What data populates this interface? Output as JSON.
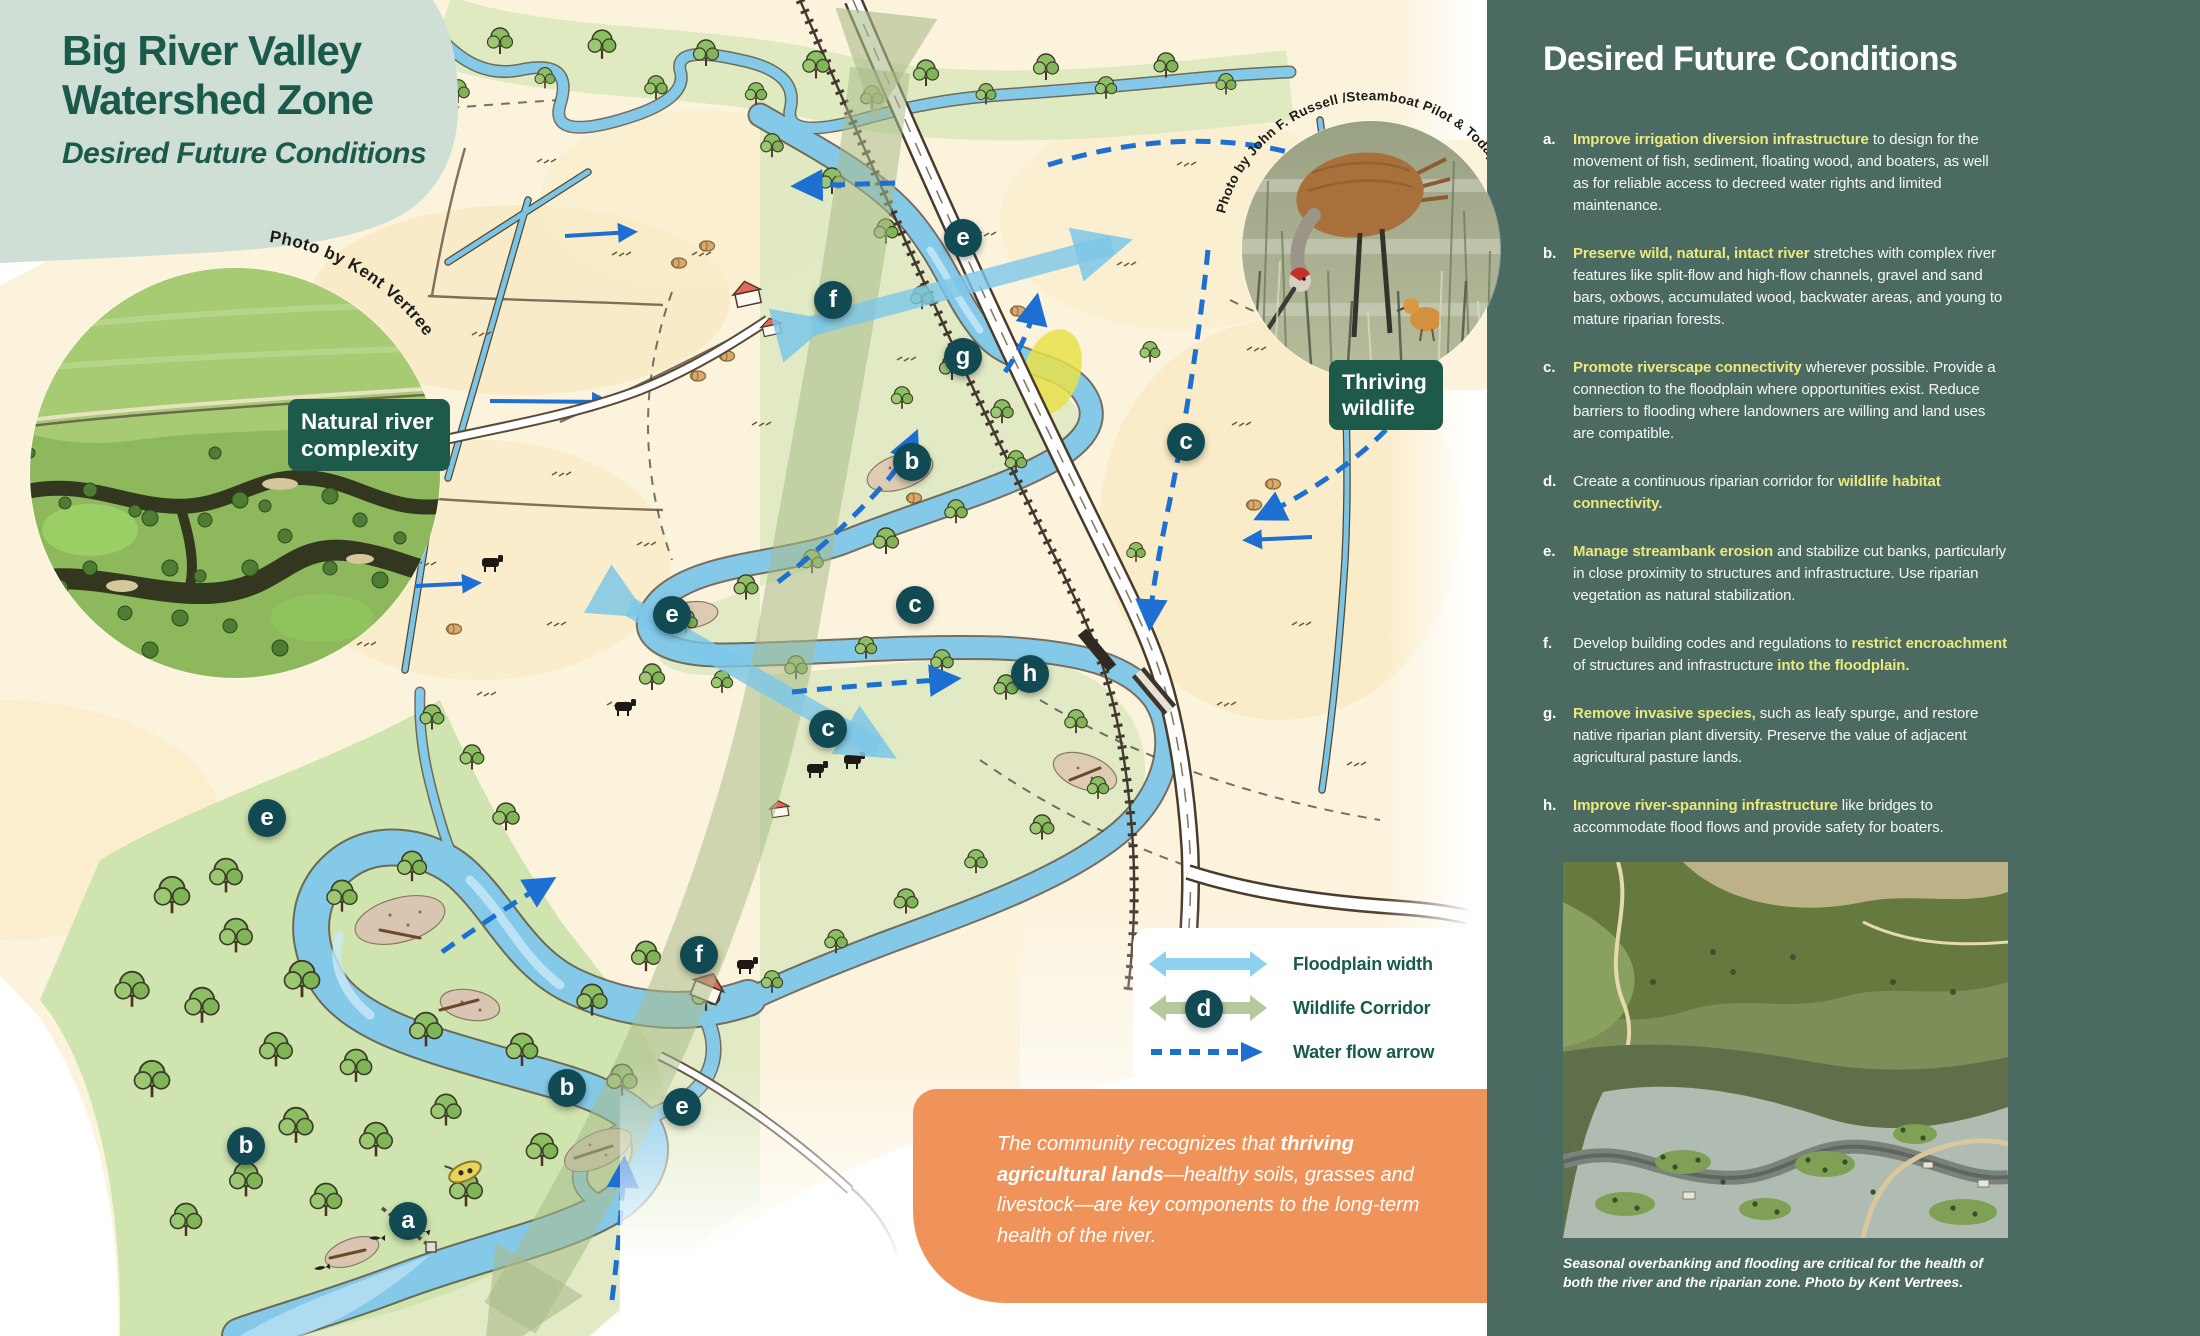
{
  "header": {
    "title_line1": "Big River Valley",
    "title_line2": "Watershed Zone",
    "subtitle": "Desired Future Conditions"
  },
  "map": {
    "photo_left_credit": "Photo by Kent Vertrees",
    "photo_left_label": "Natural river complexity",
    "photo_bird_credit": "Photo by John F. Russell /Steamboat Pilot & Today",
    "photo_bird_label": "Thriving wildlife",
    "legend": {
      "items": [
        {
          "key": "floodplain",
          "label": "Floodplain width"
        },
        {
          "key": "wildlife",
          "label": "Wildlife Corridor"
        },
        {
          "key": "flow",
          "label": "Water flow arrow"
        }
      ]
    },
    "markers": [
      {
        "letter": "e",
        "x": 963,
        "y": 238
      },
      {
        "letter": "f",
        "x": 833,
        "y": 300
      },
      {
        "letter": "g",
        "x": 963,
        "y": 357
      },
      {
        "letter": "b",
        "x": 912,
        "y": 462
      },
      {
        "letter": "c",
        "x": 1186,
        "y": 442
      },
      {
        "letter": "c",
        "x": 915,
        "y": 605
      },
      {
        "letter": "e",
        "x": 672,
        "y": 615
      },
      {
        "letter": "h",
        "x": 1030,
        "y": 674
      },
      {
        "letter": "c",
        "x": 828,
        "y": 729
      },
      {
        "letter": "e",
        "x": 267,
        "y": 818
      },
      {
        "letter": "f",
        "x": 699,
        "y": 955
      },
      {
        "letter": "b",
        "x": 567,
        "y": 1088
      },
      {
        "letter": "e",
        "x": 682,
        "y": 1107
      },
      {
        "letter": "b",
        "x": 246,
        "y": 1146
      },
      {
        "letter": "a",
        "x": 408,
        "y": 1221
      },
      {
        "letter": "d",
        "x": 1204,
        "y": 1009
      }
    ],
    "callout": {
      "text_before": "The community recognizes that ",
      "text_bold": "thriving agricultural lands",
      "text_after": "—healthy soils, grasses and livestock—are key components to the long-term health of the river."
    }
  },
  "sidebar": {
    "title": "Desired Future Conditions",
    "items": [
      {
        "letter": "a.",
        "segments": [
          {
            "t": "Improve irrigation diversion infrastructure",
            "hl": true
          },
          {
            "t": " to design for the movement of fish, sediment, floating wood, and boaters, as well as for reliable access to decreed water rights and limited maintenance.",
            "hl": false
          }
        ]
      },
      {
        "letter": "b.",
        "segments": [
          {
            "t": "Preserve wild, natural, intact river",
            "hl": true
          },
          {
            "t": " stretches with complex river features like split-flow and high-flow channels, gravel and sand bars, oxbows, accumulated wood, backwater areas, and young to mature riparian forests.",
            "hl": false
          }
        ]
      },
      {
        "letter": "c.",
        "segments": [
          {
            "t": "Promote riverscape connectivity",
            "hl": true
          },
          {
            "t": " wherever possible. Provide a connection to the floodplain where opportunities exist. Reduce barriers to flooding where landowners are willing and land uses are compatible.",
            "hl": false
          }
        ]
      },
      {
        "letter": "d.",
        "segments": [
          {
            "t": "Create a continuous riparian corridor for ",
            "hl": false
          },
          {
            "t": "wildlife habitat connectivity.",
            "hl": true
          }
        ]
      },
      {
        "letter": "e.",
        "segments": [
          {
            "t": "Manage streambank erosion",
            "hl": true
          },
          {
            "t": " and stabilize cut banks, particularly in close proximity to structures and infrastructure. Use riparian vegetation as natural stabilization.",
            "hl": false
          }
        ]
      },
      {
        "letter": "f.",
        "segments": [
          {
            "t": "Develop building codes and regulations to ",
            "hl": false
          },
          {
            "t": "restrict encroachment",
            "hl": true
          },
          {
            "t": " of structures and infrastructure ",
            "hl": false
          },
          {
            "t": "into the floodplain.",
            "hl": true
          }
        ]
      },
      {
        "letter": "g.",
        "segments": [
          {
            "t": "Remove invasive species,",
            "hl": true
          },
          {
            "t": " such as leafy spurge, and restore native riparian plant diversity. Preserve the value of adjacent agricultural pasture lands.",
            "hl": false
          }
        ]
      },
      {
        "letter": "h.",
        "segments": [
          {
            "t": "Improve river-spanning infrastructure",
            "hl": true
          },
          {
            "t": " like bridges to accommodate flood flows and provide safety for boaters.",
            "hl": false
          }
        ]
      }
    ],
    "photo_caption": "Seasonal overbanking and flooding are critical for the health of both the river and the riparian zone. Photo by Kent Vertrees."
  },
  "colors": {
    "sidebar_bg": "#4b6a61",
    "highlight_yellow": "#ece97c",
    "header_sage": "#cfdfd6",
    "deep_green": "#1b5a4a",
    "callout_orange": "#f0935a",
    "marker_teal": "#114a52",
    "flow_blue": "#1e6fd2",
    "floodplain_blue": "#7cc7e8",
    "corridor_sage": "#aabb8b"
  }
}
